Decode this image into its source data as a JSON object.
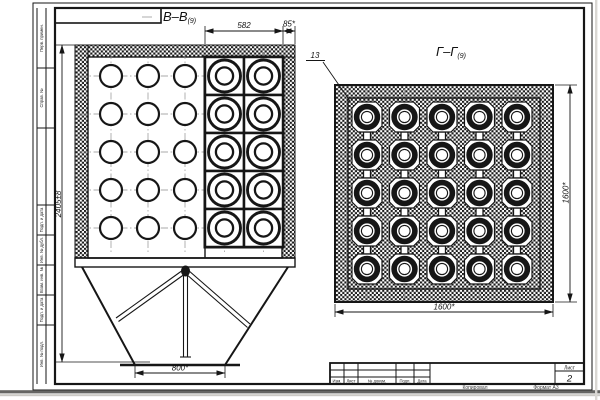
{
  "sheet": {
    "sections": {
      "bb_label": "В–В",
      "bb_sub": "(9)",
      "gg_label": "Г–Г",
      "gg_sub": "(9)"
    },
    "leader": {
      "pos_13": "13"
    },
    "dims": {
      "bb_cassette_width": "582",
      "bb_wall": "85*",
      "bb_height": "2405±8",
      "bb_outlet_width": "800*",
      "gg_width": "1600*",
      "gg_height": "1600*"
    },
    "views": {
      "bb": {
        "hole_grid": {
          "cols": 3,
          "rows": 5
        },
        "cassette_grid": {
          "cols": 2,
          "rows": 5
        }
      },
      "gg": {
        "element_grid": {
          "cols": 5,
          "rows": 5
        }
      }
    },
    "side_stamp": [
      "Перв. примен.",
      "Справ. №",
      "Подп. и дата",
      "Инв. № дубл.",
      "Взам. инв. №",
      "Подп. и дата",
      "Инв. № подл."
    ],
    "title_block": {
      "cols": [
        "Изм.",
        "Лист",
        "№ докум.",
        "Подп.",
        "Дата"
      ],
      "sheet_label": "Лист",
      "sheet_number": "2",
      "below_left": "Копировал",
      "below_right": "Формат А3"
    }
  }
}
